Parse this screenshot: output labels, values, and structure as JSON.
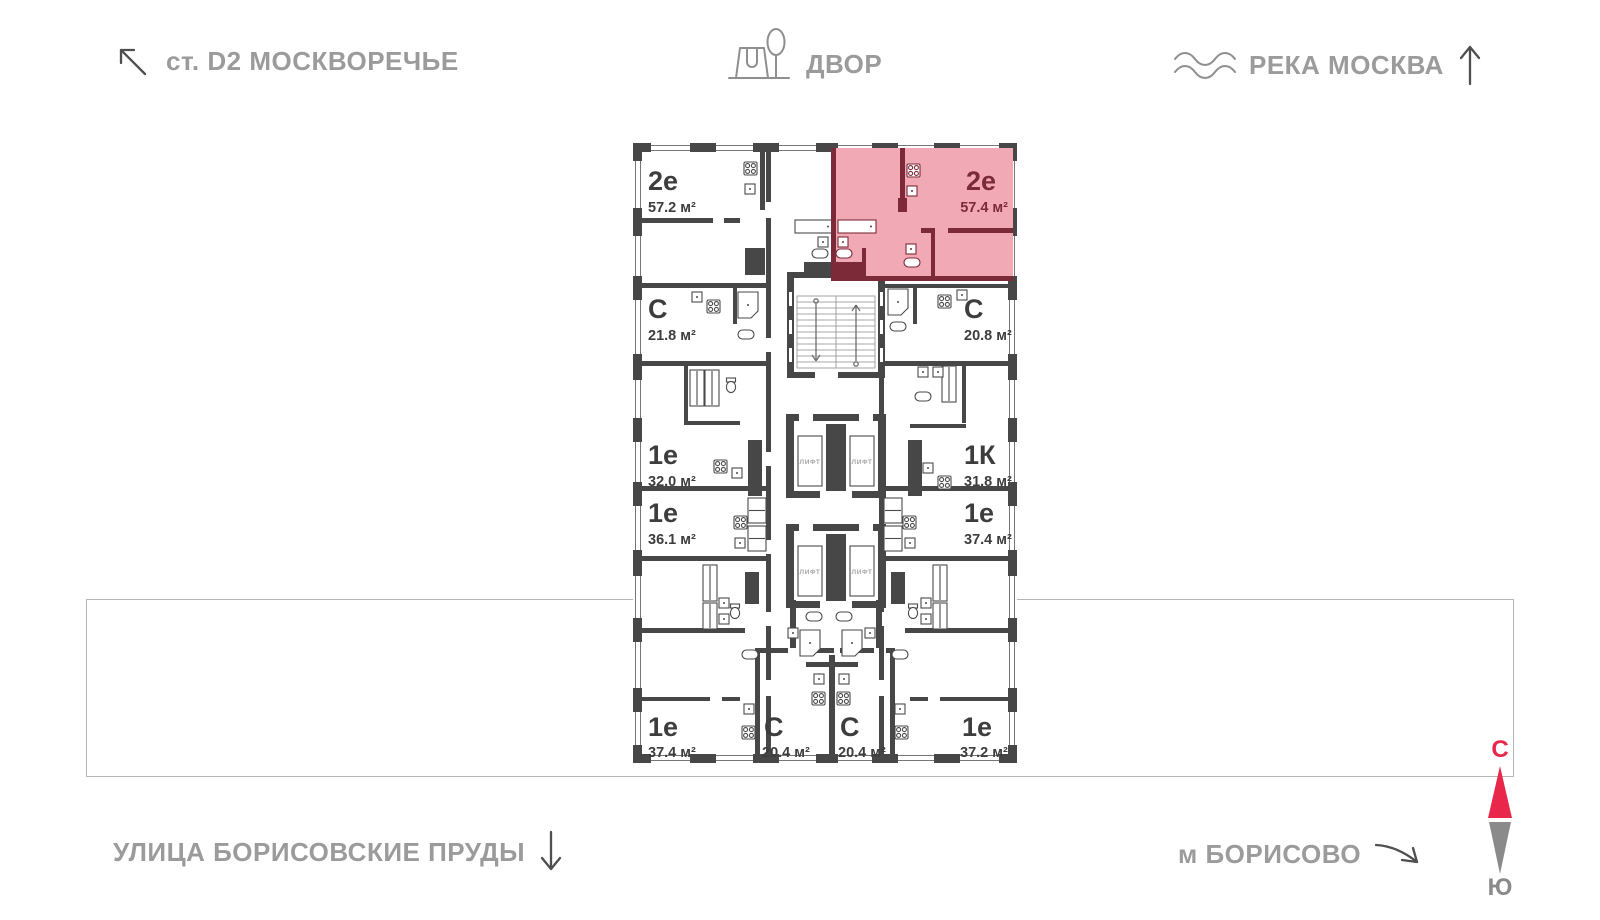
{
  "landmarks": {
    "station": "ст. D2 МОСКВОРЕЧЬЕ",
    "courtyard": "ДВОР",
    "river": "РЕКА МОСКВА",
    "street": "УЛИЦА БОРИСОВСКИЕ ПРУДЫ",
    "metro": "м БОРИСОВО"
  },
  "compass": {
    "north": "С",
    "south": "Ю"
  },
  "core": {
    "elevator": "ЛИФТ"
  },
  "apartments": [
    {
      "type": "2е",
      "area": "57.2 м²",
      "highlighted": false,
      "position": "top-left"
    },
    {
      "type": "2е",
      "area": "57.4 м²",
      "highlighted": true,
      "position": "top-right"
    },
    {
      "type": "С",
      "area": "21.8 м²",
      "highlighted": false,
      "position": "left-upper"
    },
    {
      "type": "С",
      "area": "20.8 м²",
      "highlighted": false,
      "position": "right-upper"
    },
    {
      "type": "1е",
      "area": "32.0 м²",
      "highlighted": false,
      "position": "left-middle"
    },
    {
      "type": "1К",
      "area": "31.8 м²",
      "highlighted": false,
      "position": "right-middle"
    },
    {
      "type": "1е",
      "area": "36.1 м²",
      "highlighted": false,
      "position": "left-lower"
    },
    {
      "type": "1е",
      "area": "37.4 м²",
      "highlighted": false,
      "position": "right-lower"
    },
    {
      "type": "1е",
      "area": "37.4 м²",
      "highlighted": false,
      "position": "bottom-left"
    },
    {
      "type": "С",
      "area": "20.4 м²",
      "highlighted": false,
      "position": "bottom-center-left"
    },
    {
      "type": "С",
      "area": "20.4 м²",
      "highlighted": false,
      "position": "bottom-center-right"
    },
    {
      "type": "1е",
      "area": "37.2 м²",
      "highlighted": false,
      "position": "bottom-right"
    }
  ],
  "colors": {
    "wall": "#474747",
    "highlight_fill": "#f1a9b6",
    "highlight_wall": "#7d2a38",
    "label": "#3d3d3d",
    "landmark_text": "#9b9b9b",
    "north": "#e8274b",
    "south": "#8a8a8a",
    "site_boundary": "#b5b5b5"
  }
}
